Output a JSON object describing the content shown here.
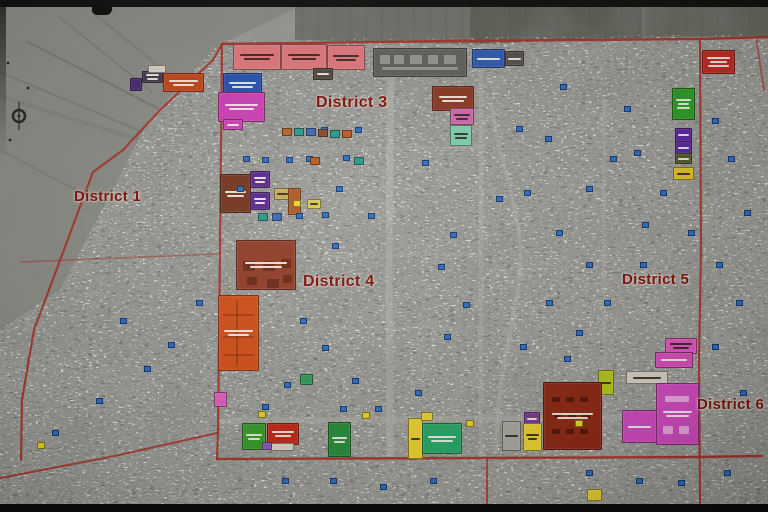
{
  "map": {
    "base_color": "#9c9c98",
    "open_land_color": "#8e8e88",
    "boundary_color": "#a8342a",
    "road_color": "#b8b8b2",
    "track_color": "#6e6e68",
    "label_color": "#7e150e",
    "districts": [
      {
        "name": "District 1",
        "x": 74,
        "y": 188,
        "size": 15
      },
      {
        "name": "District 3",
        "x": 316,
        "y": 94,
        "size": 16
      },
      {
        "name": "District 4",
        "x": 303,
        "y": 273,
        "size": 16
      },
      {
        "name": "District 5",
        "x": 622,
        "y": 271,
        "size": 15
      },
      {
        "name": "District 6",
        "x": 697,
        "y": 396,
        "size": 15
      }
    ],
    "blocks": [
      [
        233,
        44,
        46,
        24,
        "#e0797e",
        2
      ],
      [
        281,
        44,
        44,
        24,
        "#e0797e",
        2
      ],
      [
        327,
        45,
        36,
        23,
        "#e0797e",
        2
      ],
      [
        313,
        68,
        18,
        10,
        "#50483e",
        1
      ],
      [
        373,
        48,
        92,
        27,
        "#61615e",
        0,
        [
          [
            6,
            6,
            10,
            9
          ],
          [
            20,
            6,
            10,
            9
          ],
          [
            36,
            6,
            12,
            9
          ],
          [
            54,
            6,
            10,
            9
          ],
          [
            70,
            6,
            12,
            9
          ],
          [
            8,
            18,
            76,
            3
          ]
        ],
        "rgba(228,226,220,0.4)"
      ],
      [
        472,
        49,
        31,
        17,
        "#2f5cb0",
        1
      ],
      [
        505,
        51,
        17,
        13,
        "#55524e",
        1
      ],
      [
        702,
        50,
        31,
        22,
        "#bf2d26",
        3
      ],
      [
        142,
        71,
        19,
        10,
        "#453c4a",
        2
      ],
      [
        148,
        65,
        16,
        6,
        "#d8d2c4",
        0
      ],
      [
        163,
        73,
        39,
        17,
        "#c4481c",
        2
      ],
      [
        130,
        78,
        10,
        11,
        "#4a2a72",
        0
      ],
      [
        223,
        73,
        37,
        22,
        "#2a52b2",
        2
      ],
      [
        218,
        92,
        45,
        28,
        "#ce42b6",
        2
      ],
      [
        223,
        119,
        18,
        9,
        "#ce42b6",
        1
      ],
      [
        432,
        86,
        40,
        23,
        "#8a3a24",
        2
      ],
      [
        450,
        108,
        22,
        15,
        "#d06aaa",
        2
      ],
      [
        450,
        125,
        20,
        19,
        "#7ecfaa",
        2
      ],
      [
        220,
        174,
        29,
        37,
        "#76381f",
        2
      ],
      [
        250,
        171,
        18,
        15,
        "#5a2a8e",
        2
      ],
      [
        250,
        192,
        18,
        16,
        "#5a2a8e",
        2
      ],
      [
        274,
        188,
        15,
        10,
        "#c6ae5e",
        1
      ],
      [
        288,
        188,
        11,
        25,
        "#ad5a28",
        0
      ],
      [
        307,
        199,
        12,
        8,
        "#d6ca50",
        1
      ],
      [
        236,
        240,
        58,
        48,
        "#93402a",
        2,
        [
          [
            6,
            20,
            12,
            10
          ],
          [
            26,
            20,
            12,
            10
          ],
          [
            44,
            18,
            10,
            9
          ],
          [
            10,
            36,
            10,
            8
          ],
          [
            30,
            38,
            12,
            9
          ],
          [
            46,
            34,
            9,
            8
          ]
        ],
        "rgba(80,28,12,0.55)"
      ],
      [
        218,
        295,
        39,
        74,
        "#d2521c",
        2,
        [
          [
            4,
            18,
            31,
            2
          ],
          [
            4,
            40,
            31,
            2
          ],
          [
            4,
            58,
            31,
            2
          ],
          [
            17,
            4,
            2,
            66
          ]
        ],
        "rgba(140,45,10,0.5)"
      ],
      [
        300,
        374,
        11,
        9,
        "#2f9c5a",
        0
      ],
      [
        672,
        88,
        21,
        30,
        "#2f9c2a",
        3
      ],
      [
        675,
        128,
        15,
        12,
        "#5a28a0",
        1
      ],
      [
        675,
        141,
        15,
        11,
        "#5a28a0",
        1
      ],
      [
        675,
        153,
        15,
        9,
        "#585a2e",
        1
      ],
      [
        673,
        167,
        19,
        11,
        "#e0c428",
        1
      ],
      [
        665,
        338,
        30,
        14,
        "#e058c0",
        2
      ],
      [
        655,
        352,
        36,
        14,
        "#d84fb8",
        1
      ],
      [
        626,
        371,
        40,
        11,
        "#d6cfc2",
        1
      ],
      [
        656,
        383,
        41,
        60,
        "#d04cbe",
        2,
        [
          [
            6,
            42,
            10,
            8
          ],
          [
            22,
            42,
            10,
            8
          ],
          [
            8,
            12,
            24,
            6
          ]
        ],
        "rgba(255,255,255,0.5)"
      ],
      [
        622,
        410,
        33,
        31,
        "#d04cbe",
        1
      ],
      [
        598,
        370,
        14,
        23,
        "#b2c41e",
        1
      ],
      [
        543,
        382,
        57,
        66,
        "#8c2a16",
        2,
        [
          [
            8,
            14,
            8,
            5
          ],
          [
            22,
            14,
            8,
            5
          ],
          [
            36,
            14,
            8,
            5
          ],
          [
            10,
            30,
            8,
            5
          ],
          [
            24,
            30,
            8,
            5
          ],
          [
            38,
            30,
            8,
            5
          ],
          [
            8,
            46,
            8,
            5
          ],
          [
            22,
            46,
            8,
            5
          ],
          [
            36,
            46,
            8,
            5
          ]
        ],
        "rgba(58,14,8,0.6)"
      ],
      [
        524,
        412,
        14,
        11,
        "#7a3a9a",
        1
      ],
      [
        523,
        423,
        17,
        26,
        "#e8d232",
        2
      ],
      [
        502,
        421,
        17,
        28,
        "#a8a8a0",
        1
      ],
      [
        242,
        423,
        22,
        25,
        "#3a9c2e",
        2
      ],
      [
        267,
        423,
        30,
        20,
        "#c22a18",
        2
      ],
      [
        270,
        443,
        22,
        6,
        "#d8d2c4",
        0
      ],
      [
        262,
        442,
        8,
        6,
        "#8a5aba",
        0
      ],
      [
        328,
        422,
        21,
        33,
        "#2a8c3c",
        2
      ],
      [
        408,
        418,
        13,
        39,
        "#e8d232",
        1
      ],
      [
        422,
        423,
        38,
        29,
        "#2aa868",
        2
      ],
      [
        421,
        412,
        10,
        7,
        "#e8d232",
        0
      ],
      [
        214,
        392,
        11,
        13,
        "#e060c0",
        0
      ],
      [
        587,
        489,
        13,
        10,
        "#e8d232",
        0
      ]
    ],
    "blue_points": [
      [
        321,
        127
      ],
      [
        343,
        155
      ],
      [
        296,
        213
      ],
      [
        322,
        212
      ],
      [
        368,
        213
      ],
      [
        262,
        157
      ],
      [
        243,
        156
      ],
      [
        286,
        157
      ],
      [
        306,
        156
      ],
      [
        237,
        186
      ],
      [
        336,
        186
      ],
      [
        355,
        127
      ],
      [
        332,
        243
      ],
      [
        300,
        318
      ],
      [
        322,
        345
      ],
      [
        352,
        378
      ],
      [
        284,
        382
      ],
      [
        262,
        404
      ],
      [
        340,
        406
      ],
      [
        375,
        406
      ],
      [
        415,
        390
      ],
      [
        444,
        334
      ],
      [
        463,
        302
      ],
      [
        438,
        264
      ],
      [
        496,
        196
      ],
      [
        524,
        190
      ],
      [
        556,
        230
      ],
      [
        586,
        186
      ],
      [
        610,
        156
      ],
      [
        634,
        150
      ],
      [
        660,
        190
      ],
      [
        688,
        230
      ],
      [
        640,
        262
      ],
      [
        604,
        300
      ],
      [
        576,
        330
      ],
      [
        546,
        300
      ],
      [
        520,
        344
      ],
      [
        564,
        356
      ],
      [
        586,
        262
      ],
      [
        642,
        222
      ],
      [
        712,
        118
      ],
      [
        728,
        156
      ],
      [
        744,
        210
      ],
      [
        716,
        262
      ],
      [
        736,
        300
      ],
      [
        712,
        344
      ],
      [
        740,
        390
      ],
      [
        724,
        470
      ],
      [
        678,
        480
      ],
      [
        636,
        478
      ],
      [
        586,
        470
      ],
      [
        430,
        478
      ],
      [
        380,
        484
      ],
      [
        330,
        478
      ],
      [
        282,
        478
      ],
      [
        144,
        366
      ],
      [
        96,
        398
      ],
      [
        52,
        430
      ],
      [
        120,
        318
      ],
      [
        168,
        342
      ],
      [
        196,
        300
      ],
      [
        422,
        160
      ],
      [
        450,
        232
      ],
      [
        545,
        136
      ],
      [
        516,
        126
      ],
      [
        624,
        106
      ],
      [
        560,
        84
      ]
    ],
    "yellow_points": [
      [
        258,
        411
      ],
      [
        362,
        412
      ],
      [
        466,
        420
      ],
      [
        575,
        420
      ],
      [
        37,
        442
      ],
      [
        293,
        200
      ]
    ],
    "market_stalls": [
      [
        282,
        128,
        "#b86428"
      ],
      [
        294,
        128,
        "#2a9c8a"
      ],
      [
        306,
        128,
        "#3a6ab8"
      ],
      [
        318,
        129,
        "#8a4a2a"
      ],
      [
        330,
        130,
        "#2a9c8a"
      ],
      [
        342,
        130,
        "#c05a20"
      ],
      [
        258,
        213,
        "#2a9c8a"
      ],
      [
        272,
        213,
        "#3a6ab8"
      ],
      [
        310,
        157,
        "#c05a20"
      ],
      [
        354,
        157,
        "#2a9c8a"
      ]
    ],
    "boundaries": [
      [
        "222,44 455,41 700,39 768,37",
        2.4,
        0.95
      ],
      [
        "222,44 213,60 160,110 123,150 93,172 62,255 34,330 22,400 21,460",
        2.2,
        0.9
      ],
      [
        "222,44 220,250 218,433 217,459",
        2.2,
        0.9
      ],
      [
        "217,459 480,458 700,457 762,456",
        2.4,
        0.95
      ],
      [
        "0,478 110,457 217,433",
        2.0,
        0.85
      ],
      [
        "700,39 701,250 699,360 700,505",
        2.2,
        0.9
      ],
      [
        "21,262 120,258 219,254",
        1.6,
        0.5
      ],
      [
        "487,458 487,505",
        2.0,
        0.8
      ],
      [
        "756,37 764,90",
        2.0,
        0.6
      ]
    ],
    "roads": [
      [
        "M391,58 L389,260 L390,457",
        7,
        0.55
      ],
      [
        "M481,72 L481,457",
        5,
        0.4
      ],
      [
        "M222,421 L700,417",
        6,
        0.45
      ],
      [
        "M492,108 C502,180 532,230 516,300 C506,352 497,392 496,452",
        4,
        0.45
      ],
      [
        "M604,100 L604,372",
        3.5,
        0.3
      ],
      [
        "M222,150 L480,147",
        3.5,
        0.3
      ],
      [
        "M222,258 L480,254",
        3.5,
        0.25
      ],
      [
        "M222,330 L480,327",
        3,
        0.2
      ]
    ],
    "tracks": [
      [
        "M28,42 L212,136",
        2.5,
        0.5
      ],
      [
        "M0,72 L190,152",
        2,
        0.45
      ],
      [
        "M58,16 L152,92",
        2,
        0.4
      ],
      [
        "M0,150 L118,212",
        2,
        0.35
      ],
      [
        "M92,12 L228,122",
        3,
        0.3
      ],
      [
        "M0,96 L208,162",
        4,
        0.25
      ]
    ]
  }
}
